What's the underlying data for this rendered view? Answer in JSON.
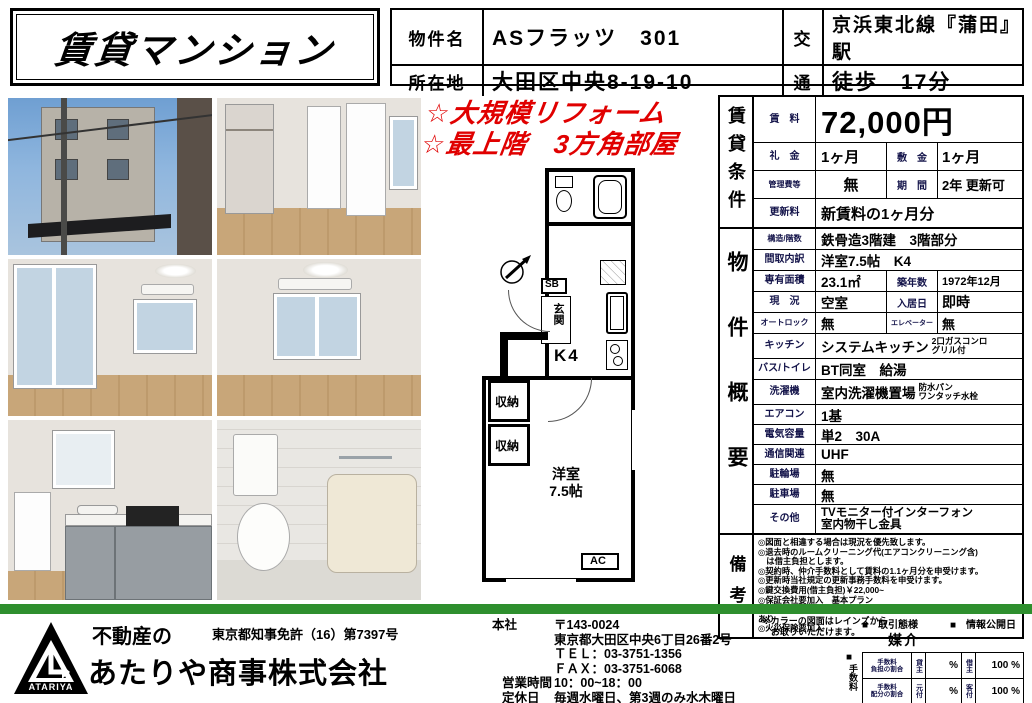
{
  "title": "賃貸マンション",
  "header": {
    "property_name_label": "物件名",
    "property_name": "ASフラッツ　301",
    "address_label": "所在地",
    "address": "大田区中央8-19-10",
    "transport_label_top": "交",
    "transport_label_bottom": "通",
    "transport_line": "京浜東北線『蒲田』駅",
    "transport_walk": "徒歩　17分"
  },
  "highlights": "☆大規模リフォーム\n☆最上階　3方角部屋",
  "floorplan": {
    "sb": "SB",
    "genkan": "玄関",
    "k4": "K4",
    "storage1": "収納",
    "storage2": "収納",
    "room": "洋室\n7.5帖",
    "ac": "AC"
  },
  "rent_section": {
    "section_label": "賃貸条件",
    "rent_label": "賃　料",
    "rent": "72,000円",
    "key_money_label": "礼　金",
    "key_money": "1ヶ月",
    "deposit_label": "敷　金",
    "deposit": "1ヶ月",
    "mgmt_fee_label": "管理費等",
    "mgmt_fee": "無",
    "period_label": "期　間",
    "period": "2年 更新可",
    "renewal_label": "更新料",
    "renewal": "新賃料の1ヶ月分"
  },
  "overview": {
    "section_label": "物件概要",
    "rows": [
      {
        "label": "構造/階数",
        "value": "鉄骨造3階建　3階部分"
      },
      {
        "label": "間取内訳",
        "value": "洋室7.5帖　K4"
      },
      {
        "label": "専有面積",
        "value": "23.1㎡",
        "label2": "築年数",
        "value2": "1972年12月"
      },
      {
        "label": "現　況",
        "value": "空室",
        "label2": "入居日",
        "value2": "即時"
      },
      {
        "label": "オートロック",
        "value": "無",
        "label2": "エレベーター",
        "value2": "無"
      },
      {
        "label": "キッチン",
        "value": "システムキッチン",
        "note": "2口ガスコンロ\nグリル付"
      },
      {
        "label": "バス/トイレ",
        "value": "BT同室　給湯"
      },
      {
        "label": "洗濯機",
        "value": "室内洗濯機置場",
        "note": "防水パン\nワンタッチ水栓"
      },
      {
        "label": "エアコン",
        "value": "1基"
      },
      {
        "label": "電気容量",
        "value": "単2　30A"
      },
      {
        "label": "通信関連",
        "value": "UHF"
      },
      {
        "label": "駐輪場",
        "value": "無"
      },
      {
        "label": "駐車場",
        "value": "無"
      },
      {
        "label": "その他",
        "value": "TVモニター付インターフォン\n室内物干し金具"
      }
    ]
  },
  "remarks": {
    "section_label": "備考",
    "lines": [
      "◎図面と相違する場合は現況を優先致します。",
      "◎退去時のルームクリーニング代(エアコンクリーニング含)\n　は借主負担とします。",
      "◎契約時、仲介手数料として賃料の1.1ヶ月分を申受けます。",
      "◎更新時当社規定の更新事務手数料を申受けます。",
      "◎鍵交換費用(借主負担)￥22,000~",
      "◎保証会社要加入　基本プラン\n　初回保証委託料　支払い賃料の総額の50%　毎年、更新保証委託料あり",
      "◎火災保険要加入"
    ]
  },
  "footer": {
    "logo_text": "ATARIYA",
    "company_prefix": "不動産の",
    "company_name": "あたりや商事株式会社",
    "license": "東京都知事免許（16）第7397号",
    "head_office_label": "本社",
    "postal": "〒143-0024",
    "address": "東京都大田区中央6丁目26番2号",
    "tel": "ＴＥＬ：03-3751-1356",
    "fax": "ＦＡＸ：03-3751-6068",
    "hours_label": "営業時間",
    "hours": "10：00~18：00",
    "closed_label": "定休日",
    "closed": "毎週水曜日、第3週のみ水木曜日",
    "color_note": "※カラーの図面はレインズから\n　お取りいただけます。",
    "transaction_marker": "■　取引態様",
    "info_marker": "■　情報公開日",
    "transaction_type": "媒介",
    "fee_marker": "■",
    "fee_label": "手数料",
    "fee_table": {
      "row1_label": "手数料\n負担の割合",
      "row1_party1": "貸主",
      "row1_val1": "%",
      "row1_party2": "借主",
      "row1_val2": "100 %",
      "row2_label": "手数料\n配分の割合",
      "row2_party1": "元付",
      "row2_val1": "%",
      "row2_party2": "客付",
      "row2_val2": "100 %"
    }
  },
  "colors": {
    "accent_red": "#e00000",
    "green_bar": "#2e8f2e",
    "label_navy": "#14144a"
  }
}
